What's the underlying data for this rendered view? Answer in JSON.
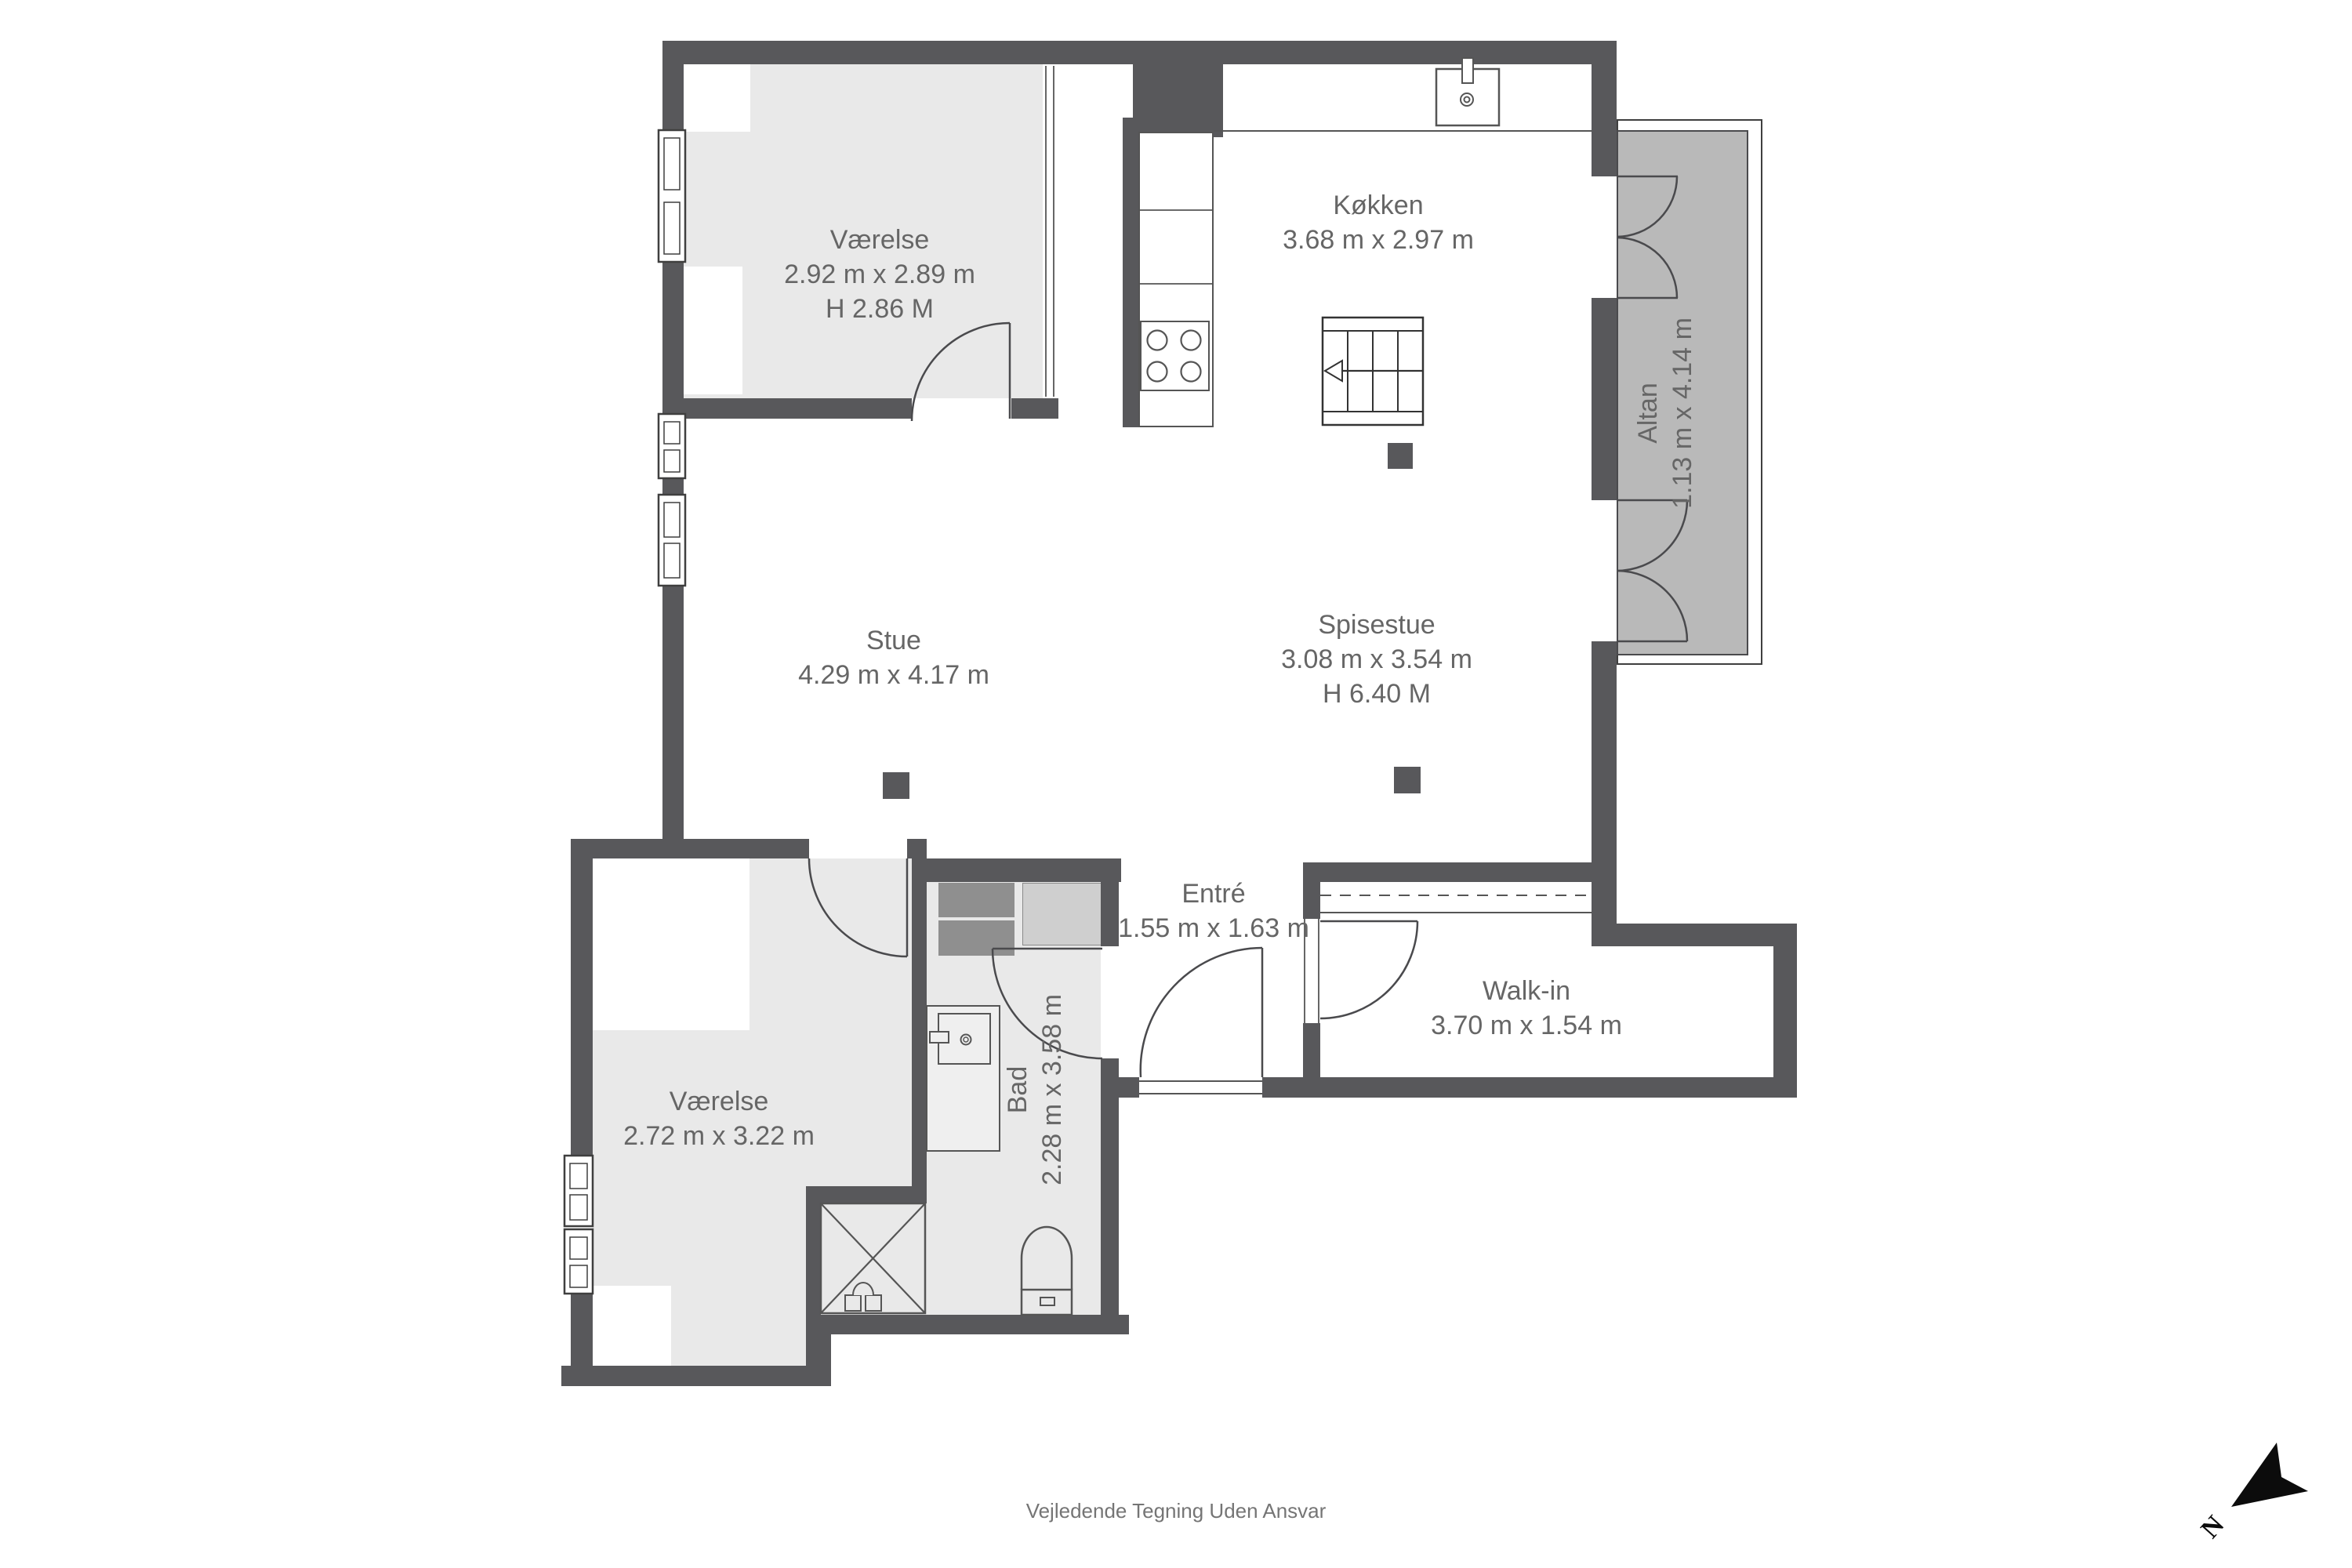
{
  "rooms": {
    "vaerelse_top": {
      "name": "Værelse",
      "dims": "2.92 m x 2.89 m",
      "ceiling": "H 2.86 M"
    },
    "koekken": {
      "name": "Køkken",
      "dims": "3.68 m x 2.97 m"
    },
    "altan": {
      "name": "Altan",
      "dims": "1.13 m x 4.14 m"
    },
    "stue": {
      "name": "Stue",
      "dims": "4.29 m x 4.17 m"
    },
    "spisestue": {
      "name": "Spisestue",
      "dims": "3.08 m x 3.54 m",
      "ceiling": "H 6.40 M"
    },
    "entre": {
      "name": "Entré",
      "dims": "1.55 m x 1.63 m"
    },
    "walk_in": {
      "name": "Walk-in",
      "dims": "3.70 m x 1.54 m"
    },
    "vaerelse_bottom": {
      "name": "Værelse",
      "dims": "2.72 m x 3.22 m"
    },
    "bad": {
      "name": "Bad",
      "dims": "2.28 m x 3.58 m"
    }
  },
  "footer": "Vejledende Tegning Uden Ansvar",
  "compass_label": "N",
  "colors": {
    "wall": "#58585b",
    "room_fill": "#e9e9e9",
    "balcony_fill": "#b9b9b9",
    "label_text": "#666666"
  }
}
